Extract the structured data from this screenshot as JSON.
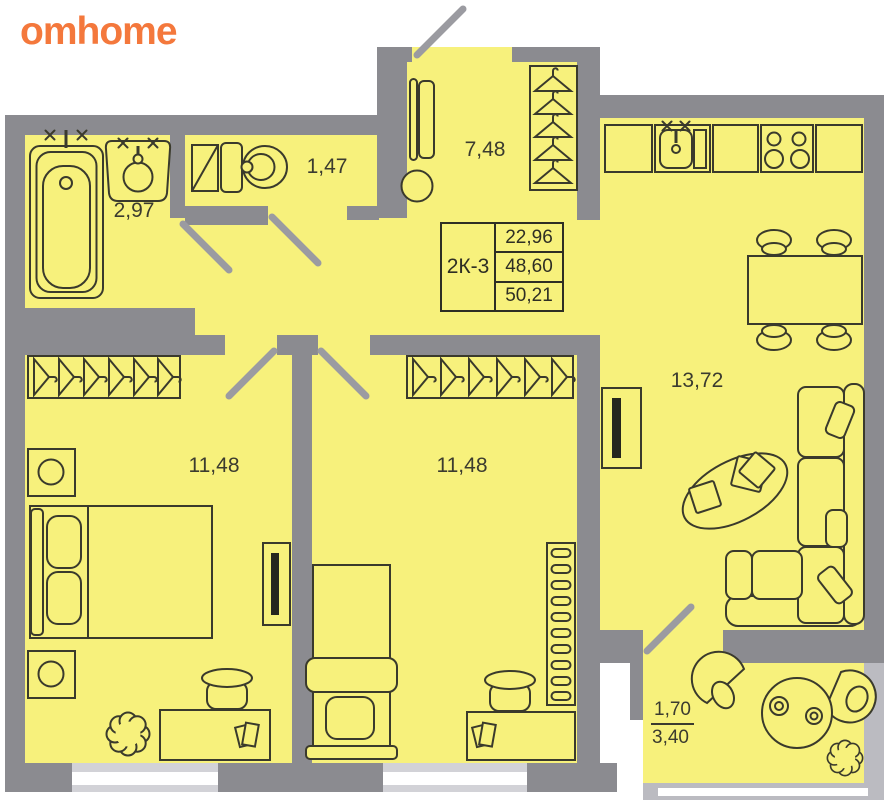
{
  "logo": {
    "text": "omhome"
  },
  "unit": {
    "code": "2К-3",
    "area_rows": [
      "22,96",
      "48,60",
      "50,21"
    ]
  },
  "rooms": {
    "bathroom": "2,97",
    "toilet": "1,47",
    "hallway": "7,48",
    "kitchen_living": "13,72",
    "bedroom_left": "11,48",
    "bedroom_middle": "11,48"
  },
  "balcony": {
    "reduced_area": "1,70",
    "full_area": "3,40"
  },
  "colors": {
    "logo_orange": "#F4783C",
    "room_fill": "#F7F17C",
    "wall_gray": "#8B8B90",
    "rail_gray": "#BBBBC1",
    "line_dark": "#3A3A2C",
    "door_leaf_gray": "#9B9BA1"
  }
}
